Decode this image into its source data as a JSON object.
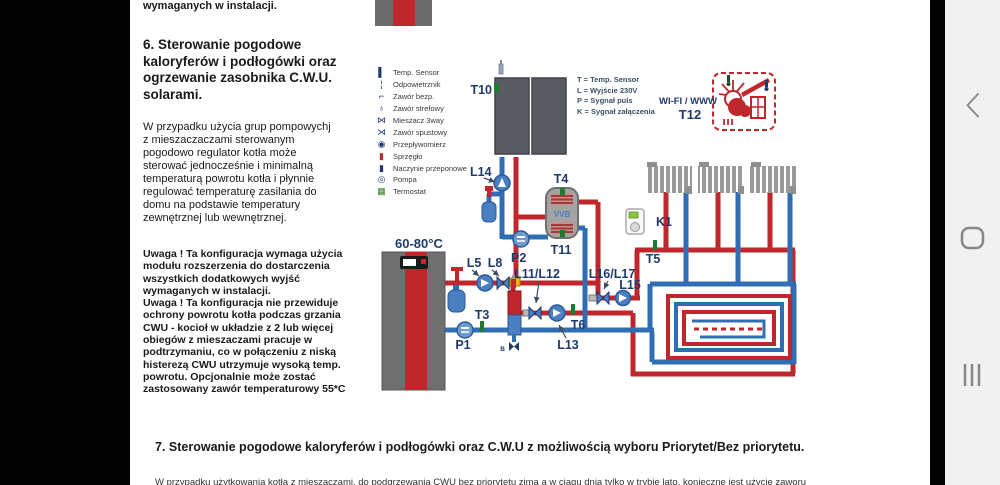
{
  "document": {
    "top_fragment": "wymaganych w instalacji.",
    "section6_heading": "6. Sterowanie pogodowe kaloryferów  i  podłogówki oraz ogrzewanie zasobnika C.W.U. solarami.",
    "section6_paragraph": "W przypadku użycia grup pompowychj z mieszaczaczami sterowanym pogodowo regulator kotła może sterować jednocześnie i minimalną temperaturą powrotu kotła i płynnie regulować temperaturę zasilania do domu na podstawie temperatury zewnętrznej lub wewnętrznej.",
    "section6_note1": "Uwaga ! Ta konfiguracja wymaga użycia modułu rozszerzenia do dostarczenia wszystkich dodatkowych wyjść wymaganych w instalacji.",
    "section6_note2": "Uwaga ! Ta konfiguracja nie przewiduje ochrony powrotu kotła podczas grzania CWU - kocioł w układzie z 2 lub więcej obiegów z mieszaczami pracuje w podtrzymaniu, co w połączeniu z niską histerezą CWU utrzymuje wysoką temp. powrotu. Opcjonalnie może zostać zastosowany zawór temperaturowy 55*C",
    "section7_heading": "7. Sterowanie pogodowe kaloryferów  i  podłogówki oraz C.W.U z możliwością wyboru Priorytet/Bez priorytetu.",
    "section7_paragraph_clipped": "W przypadku użytkowania kotła z mieszaczami, do podgrzewania CWU bez priorytetu zimą a w ciągu dnia tylko w trybie lato, konieczne jest użycie zaworu"
  },
  "legend": {
    "items": [
      {
        "label": "Temp. Sensor",
        "glyph": "▌"
      },
      {
        "label": "Odpowietrznik",
        "glyph": "¦"
      },
      {
        "label": "Zawór bezp.",
        "glyph": "⌐"
      },
      {
        "label": "Zawór strefowy",
        "glyph": "♁"
      },
      {
        "label": "Mieszacz 3way",
        "glyph": "⋈"
      },
      {
        "label": "Zawór spustowy",
        "glyph": "⋊"
      },
      {
        "label": "Przepływomierz",
        "glyph": "◉"
      },
      {
        "label": "Sprzęgło",
        "glyph": "▮"
      },
      {
        "label": "Naczynie przeponowe",
        "glyph": "▮"
      },
      {
        "label": "Pompa",
        "glyph": "◎"
      },
      {
        "label": "Termostat",
        "glyph": "▦"
      }
    ]
  },
  "signals": {
    "lines": [
      "T = Temp. Sensor",
      "L = Wyjście 230V",
      "P = Sygnał puls",
      "K = Sygnał załączenia"
    ]
  },
  "diagram": {
    "labels": {
      "t10": "T10",
      "l14": "L14",
      "p2": "P2",
      "t4": "T4",
      "vvb": "VVB",
      "t11": "T11",
      "wifi": "WI-FI / WWW",
      "t12": "T12",
      "k1": "K1",
      "t5": "T5",
      "boiler_temp": "60-80°C",
      "l5": "L5",
      "l8": "L8",
      "t3": "T3",
      "p1": "P1",
      "l11l12": "L11/L12",
      "l16l17": "L16/L17",
      "l15": "L15",
      "t6": "T6",
      "l13": "L13",
      "drain": "B"
    },
    "colors": {
      "pipe_red": "#c0272d",
      "pipe_blue": "#2f6db5",
      "label_navy": "#1f3a6b"
    }
  }
}
